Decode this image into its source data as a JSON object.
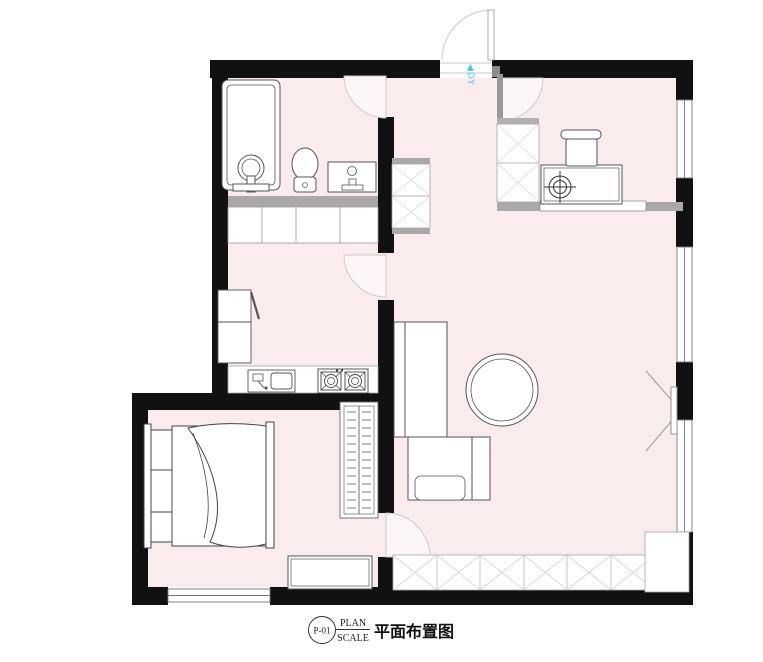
{
  "title_block": {
    "drawing_number": "P-01",
    "label_top": "PLAN",
    "label_bottom": "SCALE",
    "title_cn": "平面布置图"
  },
  "annotations": {
    "entry_marker": "◀DY"
  },
  "colors": {
    "floor_pink": "#faecec",
    "wall_black": "#111111",
    "partition_gray": "#aba8ab",
    "line_gray": "#555555",
    "accent_cyan": "#45c8e6"
  }
}
